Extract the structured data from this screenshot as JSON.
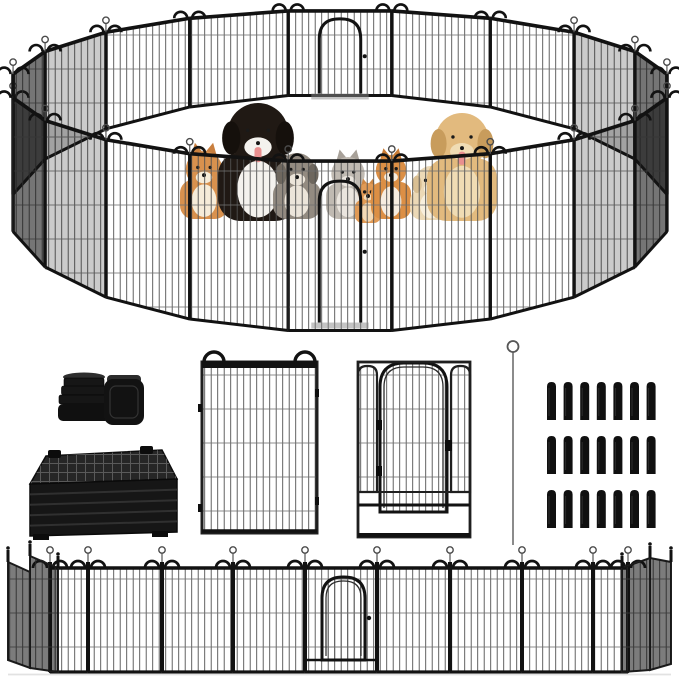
{
  "meta": {
    "image_kind": "product-photo",
    "subject": "heavy-duty metal dog playpen with gates shown assembled in a circle with pets inside, plus component parts and a flat connected row of panels"
  },
  "palette": {
    "background": "#ffffff",
    "frame": "#1f1f1f",
    "frame_dark": "#121212",
    "wire": "#4f4f4f",
    "wire_light": "#6f6f6f",
    "shading": "#141414",
    "shadow": "#e2e2e2",
    "rod_grey": "#6e6e6e",
    "tongue_pink": "#e88f8f"
  },
  "ring": {
    "cx": 340,
    "cy": 213,
    "rx": 331,
    "ry": 119,
    "panels": 20,
    "panel_height_front": 170,
    "panel_height_back": 84,
    "gates": [
      "front-center",
      "back-center"
    ]
  },
  "animals": [
    {
      "name": "corgi-dog",
      "kind": "dog-up-ears",
      "cx": 204,
      "base": 219,
      "w": 48,
      "h": 68,
      "body": "#d8914e",
      "chest": "#f6ecd9",
      "ear": "#c97f3e"
    },
    {
      "name": "bernese-mountain-dog",
      "kind": "dog",
      "cx": 258,
      "base": 221,
      "w": 80,
      "h": 118,
      "body": "#201914",
      "chest": "#f4f2ee",
      "ear": "#15100c",
      "tongue": true
    },
    {
      "name": "australian-shepherd-puppy",
      "kind": "dog",
      "cx": 297,
      "base": 219,
      "w": 48,
      "h": 66,
      "body": "#938b81",
      "chest": "#ece5da",
      "ear": "#6e675e"
    },
    {
      "name": "grey-longhair-cat",
      "kind": "cat",
      "cx": 348,
      "base": 219,
      "w": 44,
      "h": 62,
      "body": "#c0bab2",
      "chest": "#eae5de",
      "ear": "#a8a199"
    },
    {
      "name": "orange-kitten",
      "kind": "cat",
      "cx": 368,
      "base": 223,
      "w": 26,
      "h": 40,
      "body": "#e19a55",
      "chest": "#f4d9b5",
      "ear": "#cf8743"
    },
    {
      "name": "orange-tabby-cat",
      "kind": "cat",
      "cx": 391,
      "base": 219,
      "w": 40,
      "h": 64,
      "body": "#dc8f45",
      "chest": "#f7ede0",
      "ear": "#c97c35"
    },
    {
      "name": "cream-labrador-puppy",
      "kind": "dog",
      "cx": 431,
      "base": 220,
      "w": 42,
      "h": 54,
      "body": "#ecd9b6",
      "chest": "#f8efdd",
      "ear": "#d9bf93"
    },
    {
      "name": "golden-retriever",
      "kind": "dog",
      "cx": 462,
      "base": 221,
      "w": 70,
      "h": 108,
      "body": "#e2ba7e",
      "chest": "#f0dcb4",
      "ear": "#c89c5c",
      "tongue": true
    }
  ],
  "parts": {
    "foot_caps": {
      "ribbed_cap_cx": 84,
      "ribs": [
        [
          378,
          40
        ],
        [
          386,
          45
        ],
        [
          395,
          50
        ]
      ],
      "base": [
        58,
        404,
        52,
        17
      ],
      "square_cap": [
        104,
        379,
        40,
        46
      ]
    },
    "folded_stack": {
      "top": [
        [
          46,
          456
        ],
        [
          162,
          450
        ],
        [
          177,
          479
        ],
        [
          30,
          484
        ]
      ],
      "front": [
        [
          30,
          484
        ],
        [
          177,
          479
        ],
        [
          177,
          532
        ],
        [
          30,
          536
        ]
      ],
      "feet": [
        [
          33,
          534,
          16,
          6
        ],
        [
          152,
          531,
          16,
          6
        ]
      ],
      "clamps": [
        [
          48,
          450,
          13,
          8
        ],
        [
          140,
          446,
          13,
          8
        ]
      ]
    },
    "single_panel": {
      "x": 202,
      "y": 362,
      "w": 115,
      "h": 171,
      "loop_r": 10,
      "loop_cx": [
        214,
        305
      ],
      "nubs": [
        [
          198,
          404
        ],
        [
          198,
          504
        ],
        [
          315,
          389
        ],
        [
          315,
          497
        ]
      ]
    },
    "gate_panel": {
      "x": 358,
      "y": 362,
      "w": 112,
      "h": 175,
      "strips": [
        [
          358,
          366,
          19,
          126
        ],
        [
          451,
          366,
          19,
          126
        ]
      ],
      "door": [
        380,
        363,
        67,
        149
      ],
      "rail_y": 505,
      "bar_y": 535,
      "mid_y": 492,
      "hinges": [
        [
          376,
          420
        ],
        [
          376,
          466
        ]
      ],
      "latch": [
        445,
        440
      ]
    },
    "connector_rod": {
      "x": 513,
      "top": 352,
      "bottom": 545,
      "loop_r": 5.5
    },
    "ground_stakes": {
      "rows": 3,
      "cols": 7,
      "x0": 547,
      "y0": 382,
      "dx": 16.6,
      "dy": 54,
      "w": 9,
      "h": 38
    }
  },
  "flat_row": {
    "top": 568,
    "bottom": 672,
    "posts": [
      50,
      88,
      162,
      233,
      305,
      377,
      450,
      522,
      593,
      628
    ],
    "gate_between": [
      305,
      377
    ],
    "gate_door": [
      322,
      577,
      43,
      83
    ],
    "left_end": {
      "quads": [
        [
          [
            8,
            562
          ],
          [
            30,
            572
          ],
          [
            30,
            668
          ],
          [
            8,
            660
          ]
        ],
        [
          [
            30,
            556
          ],
          [
            58,
            568
          ],
          [
            58,
            672
          ],
          [
            30,
            668
          ]
        ]
      ],
      "finials": [
        [
          8,
          562
        ],
        [
          30,
          556
        ],
        [
          58,
          568
        ]
      ]
    },
    "right_end": {
      "quads": [
        [
          [
            622,
            568
          ],
          [
            650,
            558
          ],
          [
            650,
            670
          ],
          [
            622,
            672
          ]
        ],
        [
          [
            650,
            558
          ],
          [
            671,
            562
          ],
          [
            671,
            664
          ],
          [
            650,
            670
          ]
        ]
      ],
      "finials": [
        [
          622,
          568
        ],
        [
          650,
          558
        ],
        [
          671,
          562
        ]
      ]
    }
  }
}
